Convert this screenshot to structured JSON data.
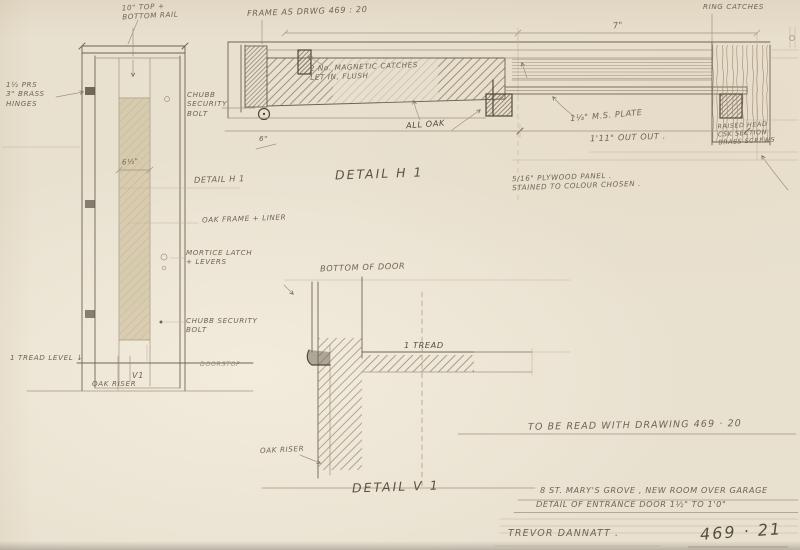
{
  "sheet": {
    "project_line": "8 ST. MARY'S GROVE , NEW ROOM OVER GARAGE",
    "subject_line": "DETAIL OF ENTRANCE DOOR   1½\" TO 1'0\"",
    "architect": "TREVOR DANNATT .",
    "drawing_number": "469 · 21",
    "reference_note": "TO BE READ WITH  DRAWING  469 · 20"
  },
  "elevation": {
    "top_rail_note": "10\" TOP +\nBOTTOM RAIL",
    "hinges_note": "1½ PRS\n3\" BRASS\nHINGES",
    "panel_width_dim": "6½\"",
    "detail_ref": "DETAIL H 1",
    "oak_frame_note": "OAK FRAME + LINER",
    "mortice_note": "MORTICE LATCH\n+ LEVERS",
    "chubb_note": "CHUBB SECURITY\nBOLT",
    "tread_level_note": "1   TREAD LEVEL ↓",
    "v1_marker": "V1",
    "oak_riser_note": "OAK RISER",
    "doorstop_note": "DOORSTOP"
  },
  "detail_h1": {
    "title": "DETAIL  H 1",
    "frame_note": "FRAME  AS DRWG  469 : 20",
    "ring_catches_note": "RING CATCHES",
    "width_dim": "7\"",
    "magnetic_catches_note": "2 No. MAGNETIC CATCHES\nLET IN, FLUSH",
    "chubb_note": "CHUBB\nSECURITY\nBOLT",
    "bolt_dim": "6\"",
    "all_oak_note": "ALL OAK",
    "plate_note": "1¼\" M.S. PLATE",
    "overall_dim": "1'11\"  OUT OUT .",
    "screws_note": "RAISED HEAD\nCSK SECTION\nBRASS SCREWS",
    "panel_note": "5/16\" PLYWOOD PANEL .\nSTAINED TO COLOUR CHOSEN ."
  },
  "detail_v1": {
    "title": "DETAIL  V 1",
    "bottom_of_door_note": "BOTTOM OF DOOR",
    "tread_note": "1 TREAD",
    "oak_riser_note": "OAK RISER"
  },
  "colors": {
    "paper": "#e9e1d0",
    "pencil": "#6e6454",
    "pencil_dark": "#4f483a",
    "panel_tint": "#d2c4a4"
  }
}
